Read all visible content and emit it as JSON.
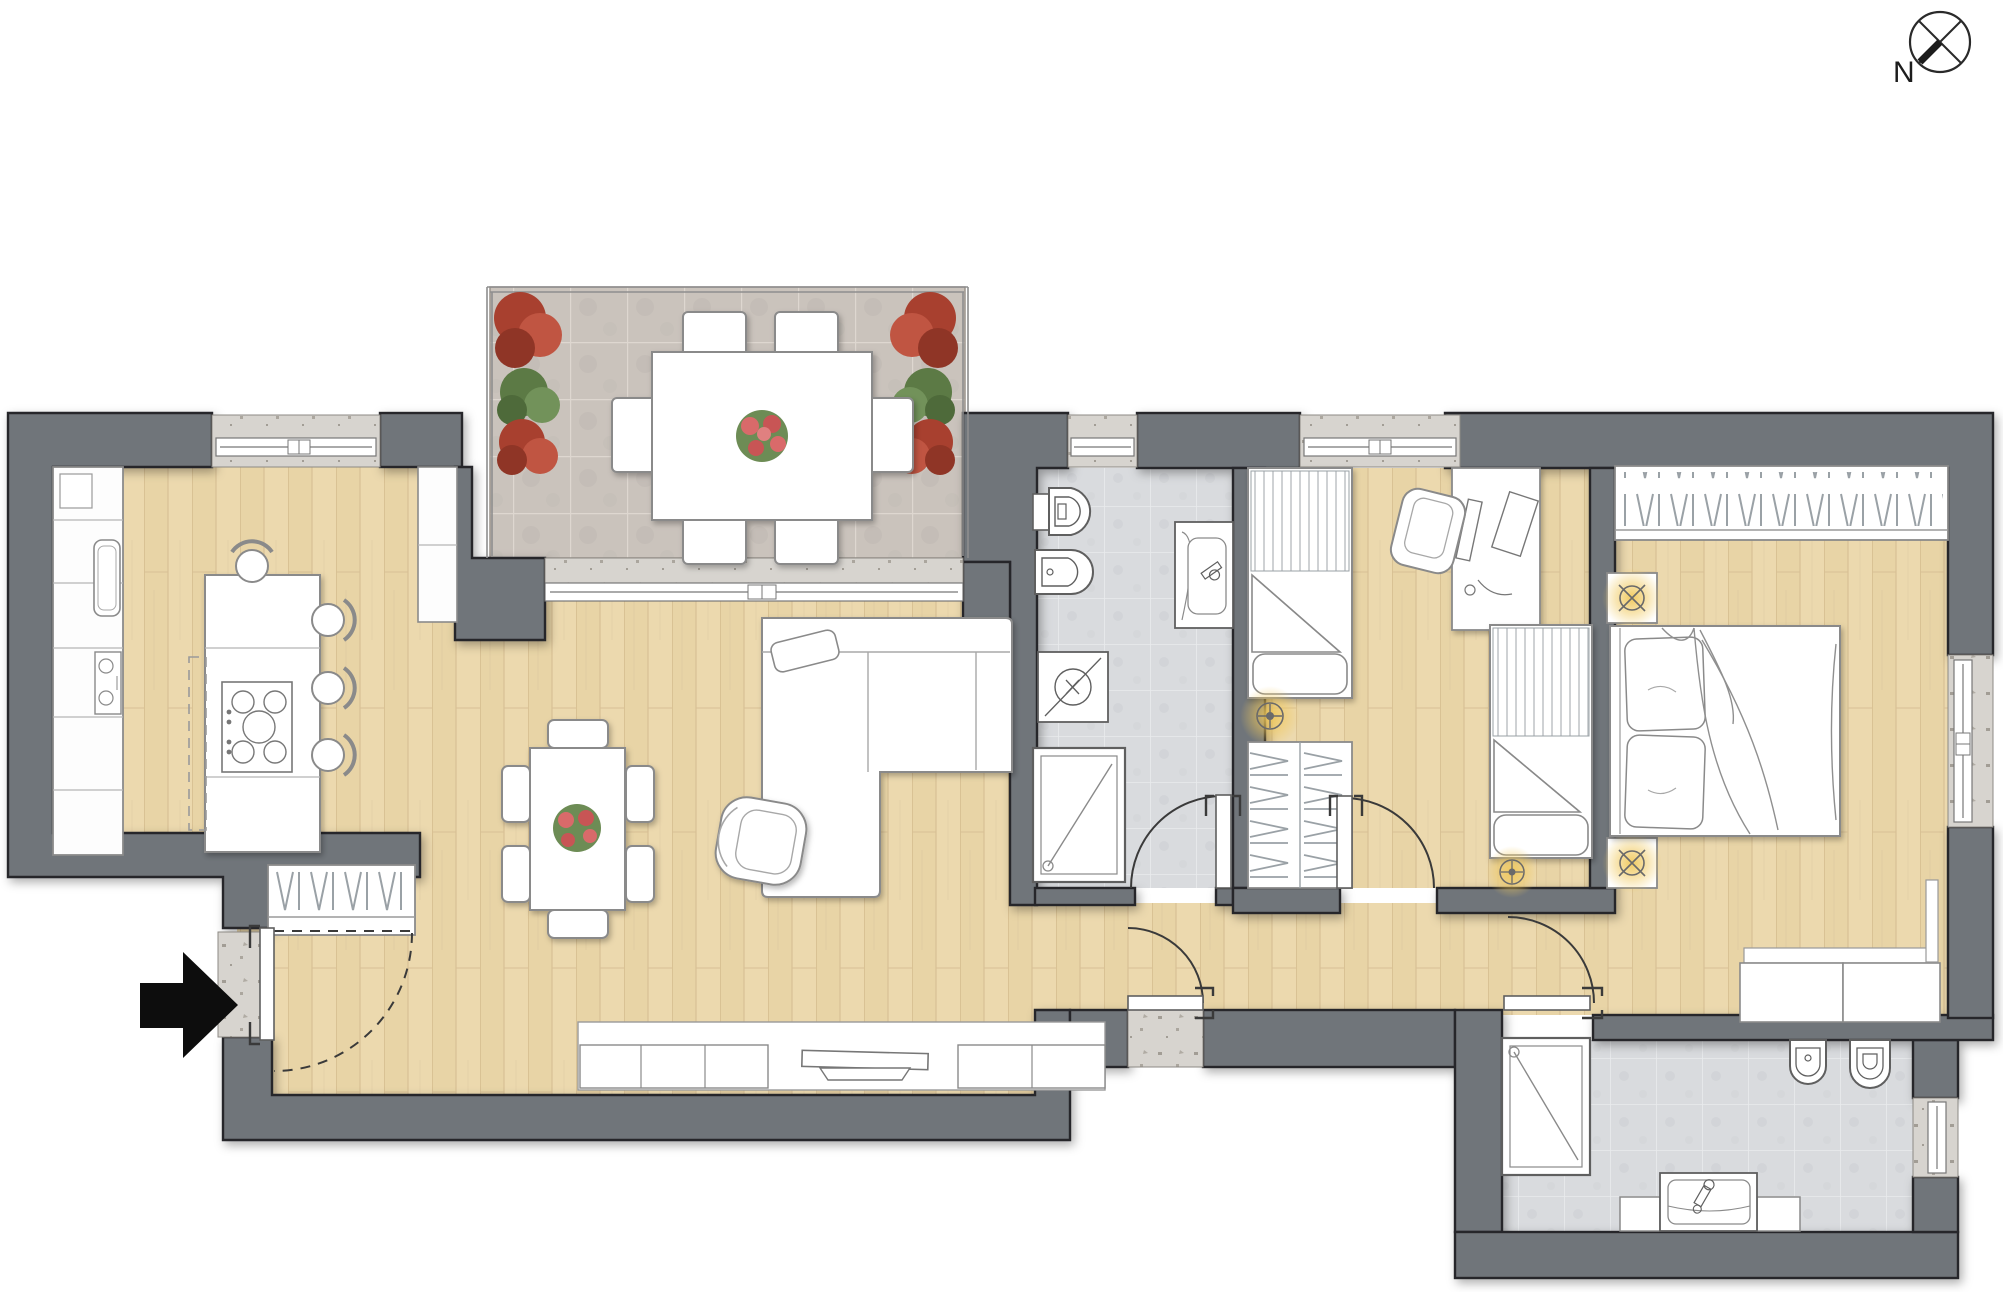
{
  "compass": {
    "north_label": "N"
  },
  "palette": {
    "wall": "#70747a",
    "wall_outline": "#26262a",
    "wood_floor": "#ecd9ae",
    "wood_plank_line": "#d3ba8c",
    "terrace_tile": "#cac3bc",
    "terrace_grout": "#ded7d0",
    "bath_tile": "#d9dbde",
    "bath_grout": "#e9ebed",
    "concrete": "#d7d4cf",
    "furniture_fill": "#ffffff",
    "furniture_outline": "#8a8a8a",
    "sanitary_outline": "#5f5f5f",
    "lamp_glow": "#f0c85a",
    "plant_red": "#b5493a",
    "plant_green": "#6b8a50",
    "flower_pink": "#d96b6b",
    "entry_arrow": "#0d0d0d",
    "door_arc": "#3a3a3a"
  },
  "rooms": [
    "terrace",
    "kitchen",
    "living-dining-room",
    "bathroom-1",
    "bedroom-2",
    "master-bedroom",
    "bathroom-2",
    "hallway",
    "entry"
  ],
  "furniture_icons": [
    "north-compass-icon",
    "entry-arrow-icon",
    "coat-closet-icon",
    "kitchen-counter-icon",
    "kitchen-sink-icon",
    "kitchen-island-icon",
    "cooktop-icon",
    "bar-stool-icon",
    "dining-table-icon",
    "dining-chair-icon",
    "flower-centerpiece-icon",
    "sofa-icon",
    "armchair-icon",
    "tv-cabinet-icon",
    "tv-icon",
    "toilet-icon",
    "bidet-icon",
    "washing-machine-icon",
    "shower-icon",
    "vanity-sink-icon",
    "single-bed-icon",
    "pillow-icon",
    "wardrobe-hangers-icon",
    "ceiling-light-icon",
    "desk-icon",
    "desk-chair-icon",
    "double-bed-icon",
    "nightstand-icon",
    "lamp-icon",
    "bench-icon",
    "planter-icon",
    "terrace-table-icon",
    "terrace-chair-icon",
    "sliding-door-icon",
    "window-icon",
    "door-swing-icon"
  ]
}
